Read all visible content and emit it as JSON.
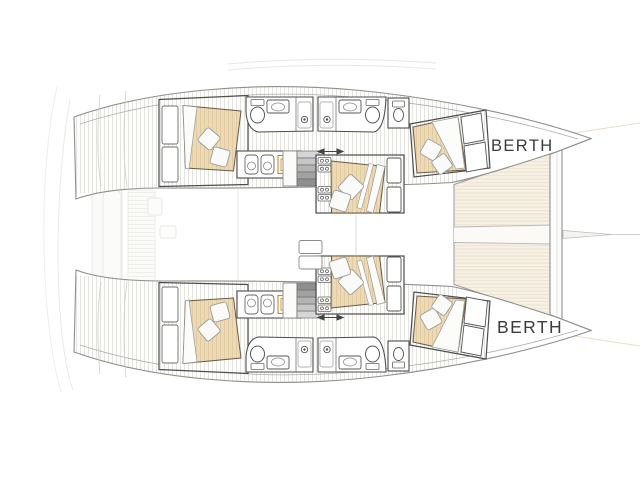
{
  "labels": {
    "berth_port": "BERTH",
    "berth_starboard": "BERTH"
  },
  "colors": {
    "background": "#ffffff",
    "outline_dark": "#4d4d4d",
    "outline_mid": "#8f8f8f",
    "underlay_faint": "#e9e9e6",
    "deck_stripe": "#e4e4e1",
    "bed_fill": "#ecd9b5",
    "bed_stripe": "#e2cba1",
    "bed_outline": "#6a5a48",
    "trampoline_fill": "#f7f1e5",
    "trampoline_stripe": "#ece3d0",
    "cooktop_accent": "#cf8a2f",
    "stairs_gray": "#b4b4b4",
    "label_text": "#3b3b3b"
  },
  "fixtures": {
    "double_beds": 6,
    "pillows_per_bed": 2,
    "toilets": 6,
    "bathroom_sinks": 4,
    "showers": 4,
    "galley_sinks": 4,
    "cooktops": 2,
    "staircases": 2,
    "berth_labels": 2,
    "trampolines": 1,
    "crossbeams": 1
  }
}
